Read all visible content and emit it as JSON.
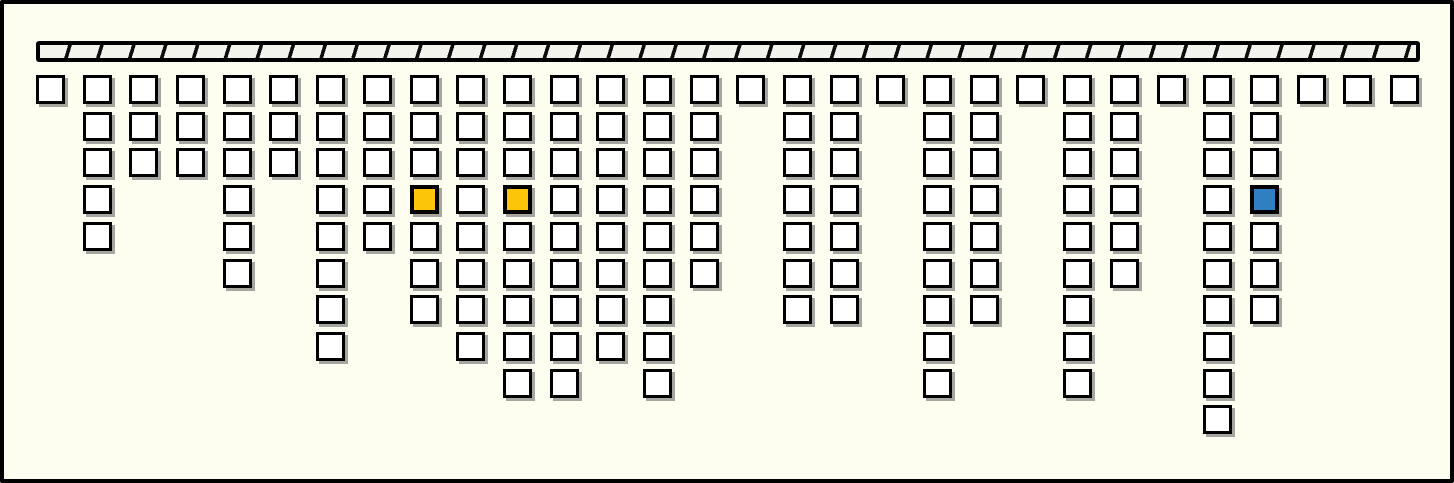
{
  "canvas": {
    "width_px": 1454,
    "height_px": 483,
    "background_color": "#fdfdf0",
    "frame_color": "#000000"
  },
  "root_bar": {
    "x": 36,
    "y": 41,
    "width": 1384,
    "height": 21,
    "fill_color": "#f3f3ed",
    "hatch_color": "#0d0d0d",
    "hatch_period_px": 30.5,
    "hatch_line_px": 3.6,
    "hatch_angle_deg": 107,
    "border_color": "#000000"
  },
  "grid": {
    "origin_x": 36,
    "origin_y": 75,
    "column_spacing": 46.69,
    "row_spacing": 36.7,
    "cell_size": 29,
    "column_count": 30,
    "max_depth": 10
  },
  "cell_style": {
    "fill_color": "#ffffff",
    "border_color": "#000000",
    "shadow_color": "rgba(80,80,80,0.5)",
    "shadow_offset_px": 3
  },
  "highlight_colors": {
    "match": "#fcc508",
    "selection": "#2e80c2"
  },
  "column_depths": [
    1,
    5,
    3,
    3,
    6,
    3,
    8,
    5,
    7,
    8,
    9,
    9,
    8,
    9,
    6,
    1,
    7,
    7,
    1,
    9,
    7,
    1,
    9,
    6,
    1,
    10,
    7,
    1,
    1,
    1
  ],
  "highlighted_cells": [
    {
      "column": 9,
      "row": 4,
      "role": "match",
      "fill_color": "#fcc508"
    },
    {
      "column": 11,
      "row": 4,
      "role": "match",
      "fill_color": "#fcc508"
    },
    {
      "column": 27,
      "row": 4,
      "role": "selection",
      "fill_color": "#2e80c2"
    }
  ]
}
